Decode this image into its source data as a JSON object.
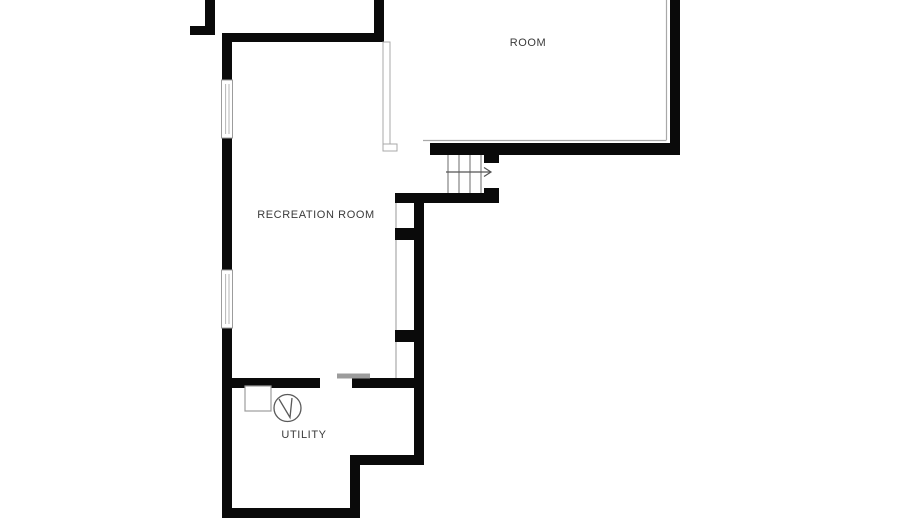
{
  "plan": {
    "type": "floor-plan",
    "rooms": {
      "room": {
        "label": "ROOM"
      },
      "recreation": {
        "label": "RECREATION ROOM"
      },
      "utility": {
        "label": "UTILITY"
      }
    },
    "symbols": {
      "stairs": {
        "icon": "stairs-up-arrow-icon",
        "treads": 4,
        "direction": "right"
      },
      "pump": {
        "icon": "pump-circle-icon"
      },
      "window_count": 2
    },
    "colors": {
      "wall": "#0a0a0a",
      "thin_line": "#a9a9a9",
      "tread_line": "#6b6b6b",
      "door_header": "#9c9c9c",
      "label_text": "#3a3a3a",
      "background": "#ffffff"
    }
  }
}
